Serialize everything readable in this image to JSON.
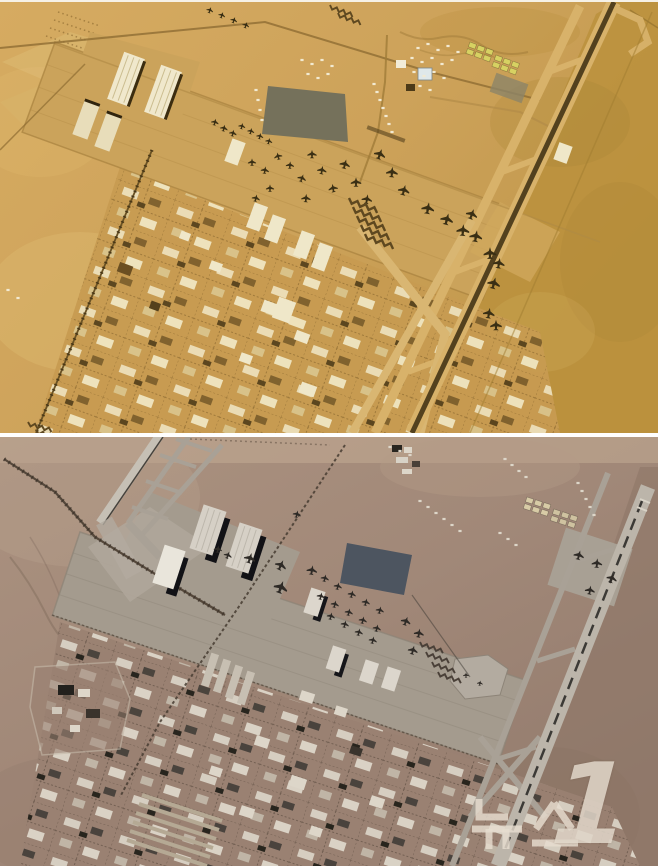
{
  "page": {
    "kind": "news-photo",
    "content": "Two-frame satellite photo comparison of a desert airbase, stacked vertically with a white divider",
    "divider_color": "#ffffff"
  },
  "watermark": {
    "text": "뉴스1",
    "hangul": "뉴스",
    "number": "1",
    "color": "#e6ddd0",
    "opacity": 0.82
  },
  "panels": {
    "top": {
      "label": "satellite-frame-1-tan",
      "palette": {
        "ground_light": "#d6ab61",
        "ground_dark": "#bd9340",
        "apron": "#cba35b",
        "runway_dark": "#53411e",
        "taxiway": "#d8b26a",
        "building_light": "#f1e9cd",
        "building_dark": "#6b4f22",
        "tents_green": "#d7d162",
        "dark_patch": "#75715b",
        "aircraft": "#3a2f14"
      },
      "aircraft": [
        [
          210,
          8,
          0.6,
          20
        ],
        [
          222,
          13,
          0.6,
          20
        ],
        [
          234,
          18,
          0.6,
          20
        ],
        [
          246,
          23,
          0.6,
          20
        ],
        [
          215,
          120,
          0.65,
          15
        ],
        [
          224,
          126,
          0.65,
          15
        ],
        [
          233,
          131,
          0.65,
          15
        ],
        [
          242,
          124,
          0.6,
          15
        ],
        [
          251,
          129,
          0.6,
          15
        ],
        [
          260,
          134,
          0.6,
          15
        ],
        [
          269,
          139,
          0.6,
          15
        ],
        [
          252,
          160,
          0.7,
          0
        ],
        [
          265,
          168,
          0.7,
          10
        ],
        [
          278,
          154,
          0.7,
          -15
        ],
        [
          290,
          163,
          0.7,
          5
        ],
        [
          302,
          176,
          0.75,
          20
        ],
        [
          270,
          186,
          0.7,
          0
        ],
        [
          256,
          196,
          0.7,
          15
        ],
        [
          312,
          152,
          0.8,
          0
        ],
        [
          322,
          168,
          0.8,
          10
        ],
        [
          333,
          186,
          0.8,
          -10
        ],
        [
          306,
          196,
          0.8,
          5
        ],
        [
          345,
          162,
          0.9,
          15
        ],
        [
          356,
          180,
          0.9,
          0
        ],
        [
          367,
          197,
          0.9,
          10
        ],
        [
          380,
          152,
          1.0,
          20
        ],
        [
          392,
          170,
          1.0,
          5
        ],
        [
          404,
          188,
          1.0,
          15
        ],
        [
          428,
          206,
          1.1,
          10
        ],
        [
          447,
          217,
          1.1,
          15
        ],
        [
          463,
          228,
          1.1,
          5
        ],
        [
          472,
          212,
          1.0,
          20
        ],
        [
          476,
          234,
          1.1,
          10
        ],
        [
          490,
          251,
          1.1,
          0
        ],
        [
          494,
          281,
          1.1,
          15
        ],
        [
          499,
          261,
          1.0,
          10
        ],
        [
          489,
          311,
          1.0,
          10
        ],
        [
          496,
          323,
          1.0,
          0
        ]
      ],
      "revetments": [
        [
          349,
          196,
          1,
          20
        ],
        [
          353,
          205,
          1,
          20
        ],
        [
          357,
          214,
          1,
          20
        ],
        [
          361,
          223,
          1,
          20
        ],
        [
          365,
          232,
          1,
          20
        ],
        [
          330,
          3,
          0.8,
          20
        ],
        [
          338,
          11,
          0.8,
          20
        ],
        [
          28,
          420,
          0.8,
          15
        ],
        [
          36,
          428,
          0.8,
          15
        ]
      ],
      "specks": [
        [
          374,
          82
        ],
        [
          377,
          90
        ],
        [
          380,
          98
        ],
        [
          383,
          106
        ],
        [
          386,
          114
        ],
        [
          389,
          122
        ],
        [
          392,
          130
        ],
        [
          256,
          88
        ],
        [
          258,
          98
        ],
        [
          260,
          108
        ],
        [
          262,
          118
        ],
        [
          418,
          46
        ],
        [
          428,
          42
        ],
        [
          438,
          48
        ],
        [
          448,
          44
        ],
        [
          458,
          50
        ],
        [
          412,
          56
        ],
        [
          422,
          60
        ],
        [
          432,
          56
        ],
        [
          442,
          62
        ],
        [
          452,
          58
        ],
        [
          414,
          70
        ],
        [
          424,
          74
        ],
        [
          434,
          70
        ],
        [
          444,
          76
        ],
        [
          420,
          84
        ],
        [
          430,
          88
        ],
        [
          302,
          58
        ],
        [
          312,
          62
        ],
        [
          322,
          58
        ],
        [
          332,
          64
        ],
        [
          308,
          72
        ],
        [
          318,
          76
        ],
        [
          328,
          72
        ],
        [
          8,
          288
        ],
        [
          18,
          296
        ]
      ]
    },
    "bottom": {
      "label": "satellite-frame-2-gray",
      "palette": {
        "ground": "#a18878",
        "ground_light": "#b7a08c",
        "apron": "#a49b8e",
        "runway_pale": "#c6c0b5",
        "runway_centerline": "#3c3a36",
        "taxiway": "#a9a196",
        "building_light": "#d6d0c6",
        "hangar_shadow": "#121216",
        "dark_patch": "#4d5560",
        "tents_cream": "#d8cba6",
        "aircraft": "#2e2a26"
      },
      "aircraft": [
        [
          250,
          121,
          1.0,
          18
        ],
        [
          281,
          128,
          1.0,
          25
        ],
        [
          281,
          150,
          1.2,
          20
        ],
        [
          312,
          133,
          0.9,
          10
        ],
        [
          325,
          141,
          0.7,
          15
        ],
        [
          338,
          149,
          0.7,
          15
        ],
        [
          352,
          157,
          0.7,
          15
        ],
        [
          366,
          165,
          0.7,
          15
        ],
        [
          380,
          173,
          0.7,
          15
        ],
        [
          321,
          159,
          0.7,
          15
        ],
        [
          335,
          167,
          0.7,
          15
        ],
        [
          349,
          175,
          0.7,
          15
        ],
        [
          363,
          183,
          0.7,
          15
        ],
        [
          377,
          191,
          0.7,
          15
        ],
        [
          331,
          179,
          0.7,
          15
        ],
        [
          345,
          187,
          0.7,
          15
        ],
        [
          359,
          195,
          0.7,
          15
        ],
        [
          373,
          203,
          0.7,
          15
        ],
        [
          406,
          184,
          0.85,
          20
        ],
        [
          419,
          196,
          0.85,
          10
        ],
        [
          413,
          213,
          0.85,
          15
        ],
        [
          579,
          118,
          0.9,
          15
        ],
        [
          597,
          126,
          0.9,
          5
        ],
        [
          612,
          141,
          0.9,
          20
        ],
        [
          590,
          153,
          0.85,
          10
        ],
        [
          297,
          77,
          0.7,
          15
        ],
        [
          218,
          112,
          0.7,
          10
        ],
        [
          228,
          118,
          0.7,
          20
        ],
        [
          466,
          238,
          0.5,
          0
        ],
        [
          480,
          246,
          0.5,
          10
        ]
      ],
      "revetments": [
        [
          420,
          205,
          0.8,
          18
        ],
        [
          426,
          215,
          0.8,
          18
        ],
        [
          432,
          225,
          0.8,
          18
        ],
        [
          438,
          235,
          0.8,
          18
        ]
      ],
      "specks": [
        [
          420,
          64
        ],
        [
          428,
          70
        ],
        [
          436,
          76
        ],
        [
          444,
          82
        ],
        [
          452,
          88
        ],
        [
          460,
          94
        ],
        [
          500,
          96
        ],
        [
          508,
          102
        ],
        [
          516,
          108
        ],
        [
          578,
          46
        ],
        [
          582,
          54
        ],
        [
          586,
          62
        ],
        [
          590,
          70
        ],
        [
          594,
          78
        ],
        [
          390,
          10
        ],
        [
          400,
          14
        ],
        [
          410,
          18
        ],
        [
          505,
          22
        ],
        [
          512,
          28
        ],
        [
          519,
          34
        ],
        [
          526,
          40
        ]
      ]
    }
  }
}
